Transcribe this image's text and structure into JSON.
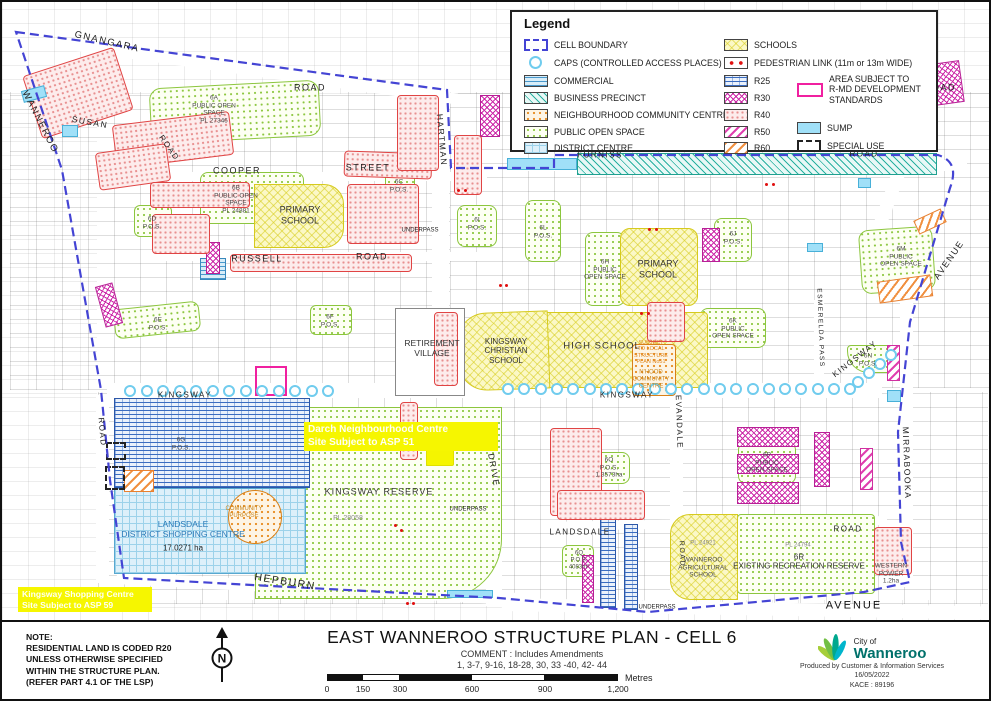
{
  "title_block": {
    "title": "EAST WANNEROO STRUCTURE PLAN - CELL 6",
    "comment_line1": "COMMENT : Includes Amendments",
    "comment_line2": "1, 3-7, 9-16, 18-28, 30, 33 -40, 42- 44",
    "note": "NOTE:\nRESIDENTIAL LAND IS CODED R20\nUNLESS OTHERWISE SPECIFIED\nWITHIN THE STRUCTURE PLAN.\n(REFER PART 4.1 OF THE LSP)",
    "north_letter": "N",
    "scale": {
      "ticks": [
        "0",
        "150",
        "300",
        "600",
        "900",
        "1,200"
      ],
      "unit": "Metres"
    },
    "credit": {
      "org_line1": "City of",
      "org_line2": "Wanneroo",
      "produced": "Produced by Customer & Information Services",
      "date": "16/05/2022",
      "ref": "KACE : 89196"
    }
  },
  "legend": {
    "title": "Legend",
    "col1": [
      {
        "label": "CELL BOUNDARY"
      },
      {
        "label": "CAPS (CONTROLLED ACCESS PLACES)"
      },
      {
        "label": "COMMERCIAL"
      },
      {
        "label": "BUSINESS PRECINCT"
      },
      {
        "label": "NEIGHBOURHOOD COMMUNITY CENTRE"
      },
      {
        "label": "PUBLIC OPEN SPACE"
      },
      {
        "label": "DISTRICT CENTRE"
      }
    ],
    "col2": [
      {
        "label": "SCHOOLS"
      },
      {
        "label": "PEDESTRIAN LINK (11m or 13m WIDE)"
      },
      {
        "label": "R25"
      },
      {
        "label": "R30"
      },
      {
        "label": "R40"
      },
      {
        "label": "R50"
      },
      {
        "label": "R60"
      }
    ],
    "col3": [
      {
        "label": "AREA SUBJECT TO\nR-MD DEVELOPMENT\nSTANDARDS"
      },
      {
        "label": "SUMP"
      },
      {
        "label": "SPECIAL USE"
      }
    ]
  },
  "map": {
    "colors": {
      "boundary_blue": "#4444d4",
      "caps_blue": "#70ccee",
      "highlight_yellow": "#f6f600",
      "rmd_pink": "#f020a0",
      "pos_green": "#8cc63e",
      "school_yellow": "#d6ca1e",
      "logo_green": "#a6ce39",
      "logo_teal": "#00b5cc",
      "logo_text": "#00716b"
    },
    "labels": {
      "gnangara": "GNANGARA",
      "gnangara_road": "ROAD",
      "top_right_road": "ROAD",
      "wanneroo": "WANNEROO",
      "susan": "SUSAN",
      "susan_road": "ROAD",
      "cooper": "COOPER",
      "cooper_street": "STREET",
      "russell": "RUSSELL",
      "russell_road": "ROAD",
      "furniss": "FURNISS",
      "furniss_road": "ROAD",
      "hartman": "HARTMAN",
      "drive": "DRIVE",
      "kingsway_left": "KINGSWAY",
      "kingsway_mid": "KINGSWAY",
      "kingsway_right": "KINGSWAY",
      "evandale": "EVANDALE",
      "esmerelda_pass": "ESMERELDA PASS",
      "mirrabooka": "MIRRABOOKA",
      "avenue_ne": "AVENUE",
      "avenue_se": "AVENUE",
      "hepburn": "HEPBURN",
      "landsdale_road": "LANDSDALE",
      "landsdale_road2": "ROAD",
      "road_left": "ROAD",
      "road_mid": "ROAD",
      "underpass1": "UNDERPASS",
      "underpass2": "UNDERPASS",
      "underpass3": "UNDERPASS",
      "pos_6a": "6A\nPUBLIC OPEN\nSPACE\nPL 27346",
      "pos_6b": "6B\nPUBLIC OPEN\nSPACE\nPL 24881",
      "pos_6c": "6C\nP.O.S.",
      "pos_6d": "6D\nP.O.S.",
      "pos_6e": "6E\nP.O.S.",
      "pos_6f": "6F\nP.O.S.",
      "pos_6g": "6G\nP.O.S.",
      "pos_6h": "6H\nPUBLIC\nOPEN SPACE",
      "pos_6i": "6I\nP.O.S.",
      "pos_6j": "6J\nP.O.S.",
      "pos_6k": "6K\nPUBLIC\nOPEN SPACE",
      "pos_6l": "6L\nP.O.S.",
      "pos_6m": "6M\nPUBLIC\nOPEN SPACE",
      "pos_6n": "6N\nP.O.S.",
      "pos_6o": "6O\nP.O.S.\n1.3573ha",
      "pos_6p": "6P\nPUBLIC\nOPEN SPACE",
      "pos_6q": "6Q\nP.O.S.\n4083m²",
      "primary_school_w": "PRIMARY\nSCHOOL",
      "primary_school_e": "PRIMARY\nSCHOOL",
      "high_school": "HIGH SCHOOL",
      "christian_school": "KINGSWAY\nCHRISTIAN\nSCHOOL",
      "retirement": "RETIREMENT\nVILLAGE",
      "kingsway_reserve": "KINGSWAY RESERVE",
      "pl_28058": "PL 28058",
      "community_purpose": "COMMUNITY\nPURPOSE",
      "landsdale_dc": "LANDSDALE\nDISTRICT SHOPPING CENTRE",
      "landsdale_dc_area": "17.0271 ha",
      "subject_lsp51": "SUBJECT\nTO LOCAL\nSTRUCTURE\nPLAN No51",
      "nhood_cc": "N'HOOD\nCOMMUNITY\nCENTRE",
      "pl_24921": "PL 24921",
      "agri_school": "WANNEROO\nAGRICULTURAL\nSCHOOL",
      "pl_24794": "PL 24794",
      "recreation_6r": "6R\nEXISTING RECREATION RESERVE",
      "western_power": "WESTERN\nPOWER\n1.2ha",
      "darch_note": "Darch Neighbourhood Centre\nSite Subject to ASP 51",
      "kingsway_sc_note": "Kingsway Shopping Centre\nSite Subject to ASP 59"
    }
  }
}
